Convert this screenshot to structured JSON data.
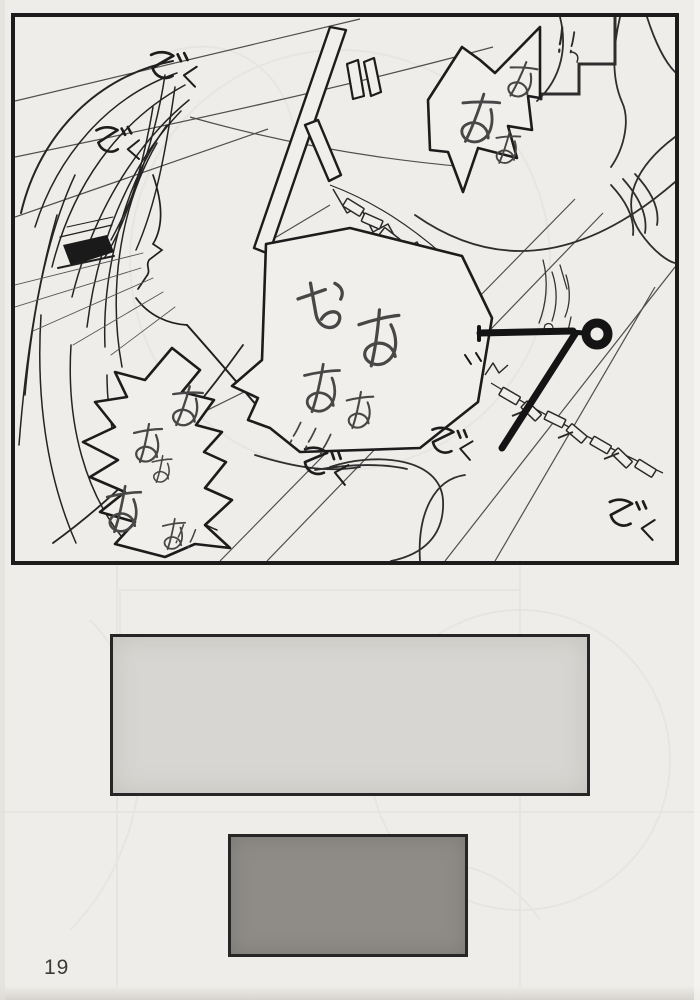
{
  "page": {
    "number": "19"
  },
  "panel": {
    "bubbles": [
      {
        "text": "ああぁ"
      },
      {
        "text": "おああぁ！！！"
      },
      {
        "text": "ああぁあぁ！！"
      }
    ],
    "sfx": [
      "ぞく",
      "ぞく",
      "ぞく",
      "ぞく",
      "ぞく"
    ],
    "exclamation": "！！"
  },
  "colors": {
    "paper": "#efede9",
    "ink": "#1c1c1c",
    "blank_panel_light": "#d8d6d2",
    "blank_panel_dark": "#8f8c88"
  }
}
